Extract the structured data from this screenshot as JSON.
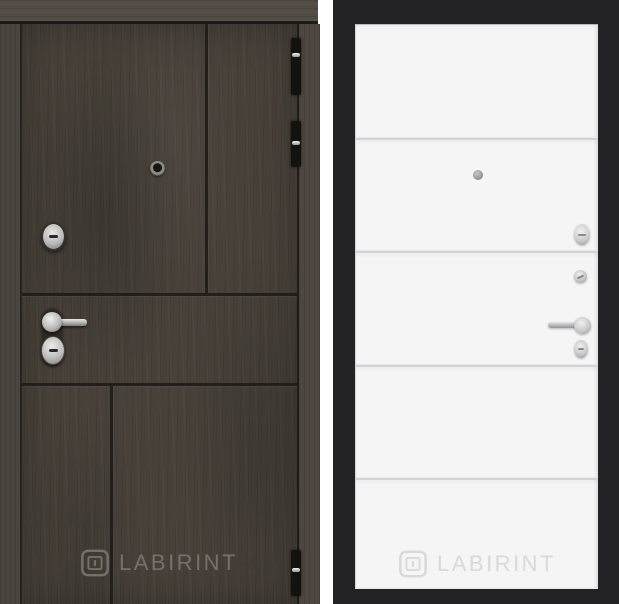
{
  "brand": {
    "name": "LABIRINT"
  },
  "left_door": {
    "label": "entrance-door-exterior-dark-wood",
    "watermark": "LABIRINT",
    "colors": {
      "wood_base": "#474139",
      "frame_wood": "#524c45",
      "panel_seam": "#221f1b",
      "hinge": "#131211",
      "hardware_metal": "#c9c9c9",
      "watermark_text": "#75716a"
    },
    "hardware": {
      "peephole": "peephole",
      "upper_lock": "lock-cylinder",
      "handle": "lever-handle",
      "lower_lock": "keyhole-escutcheon",
      "hinge_count": 3
    }
  },
  "right_door": {
    "label": "entrance-door-interior-white-panel",
    "watermark": "LABIRINT",
    "molding_lines": 4,
    "colors": {
      "background": "#232325",
      "panel": "#f5f5f6",
      "panel_seam": "#d3d3d6",
      "hardware_metal": "#c6c6c8",
      "watermark_text": "#d9d9d9"
    },
    "hardware": {
      "peephole": "peephole",
      "upper_lock": "thumb-turn",
      "night_latch": "night-latch-knob",
      "handle": "lever-handle",
      "lower_lock": "keyhole-escutcheon"
    }
  }
}
